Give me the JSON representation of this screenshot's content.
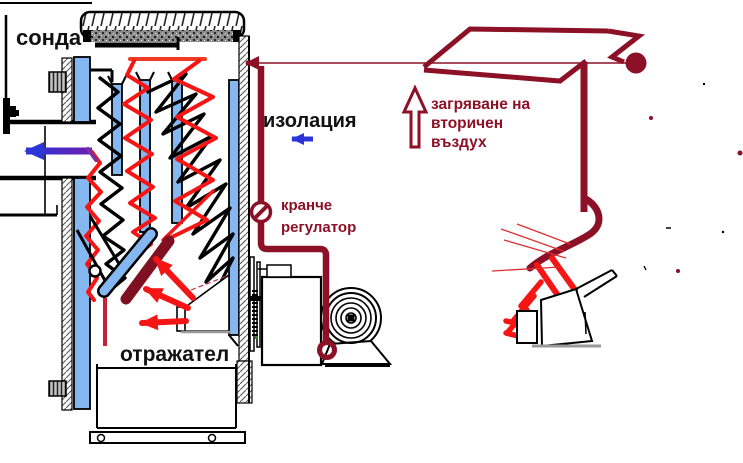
{
  "labels": {
    "probe": "сонда",
    "insulation": "изолация",
    "valve_regulator": [
      "кранче",
      "регулатор"
    ],
    "secondary_air_heating": [
      "загряване на",
      "вторичен",
      "въздух"
    ],
    "reflector": "отражател"
  },
  "colors": {
    "pipe_maroon": "#8c1127",
    "reflector_maroon": "#7e1022",
    "flame_red": "#f51515",
    "crimson": "#c52033",
    "water_plate_blue": "#85b7f0",
    "flue_arrow_blue": "#2b35d8",
    "flue_arrow_purple": "#6a1fb0",
    "outline_black": "#000000",
    "base_gray": "#999999",
    "background": "#ffffff"
  }
}
